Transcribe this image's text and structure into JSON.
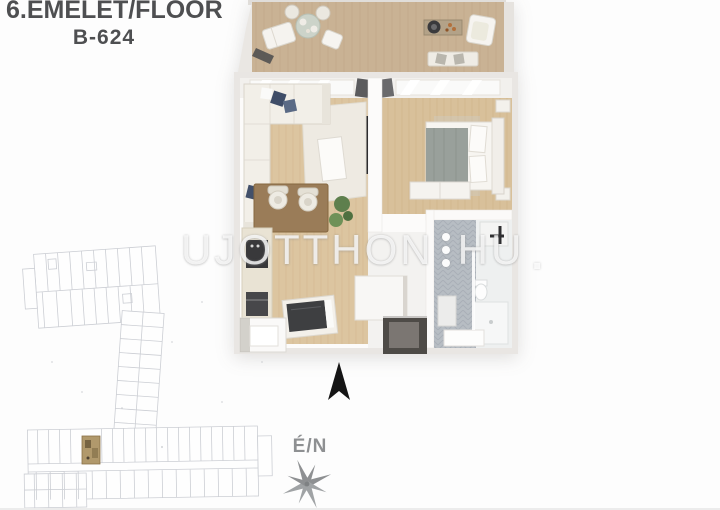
{
  "header": {
    "floor_label": "6.EMELET/FLOOR",
    "unit_label": "B-624"
  },
  "watermark": {
    "brand": "UJOTTHON",
    "tld": "HU",
    "suffix": ".",
    "separator_icon": "three-dots-vertical"
  },
  "compass": {
    "label": "É/N",
    "north_arrow_icon": "north-arrow",
    "rose_icon": "compass-rose-8-point"
  },
  "floorplan": {
    "type": "3d-apartment-floor-plan",
    "areas": [
      "terrace",
      "living-room",
      "bedroom",
      "kitchen-dining",
      "hallway",
      "bathroom",
      "entry"
    ]
  },
  "site_plan": {
    "type": "building-level-outline-drawing",
    "highlighted_unit_color": "#b1996c"
  },
  "colors": {
    "title_text": "#4e4f51",
    "compass_gray": "#8e9092",
    "north_arrow": "#151515",
    "interior_wood": "#dcc5a0",
    "terrace_wood": "#c9b294",
    "wall_light": "#e9e6e3",
    "pillow_navy": "#3f4d68",
    "bath_tile": "#b7bdc3",
    "site_plan_line": "#c7cad0",
    "watermark_white": "#ffffff"
  }
}
